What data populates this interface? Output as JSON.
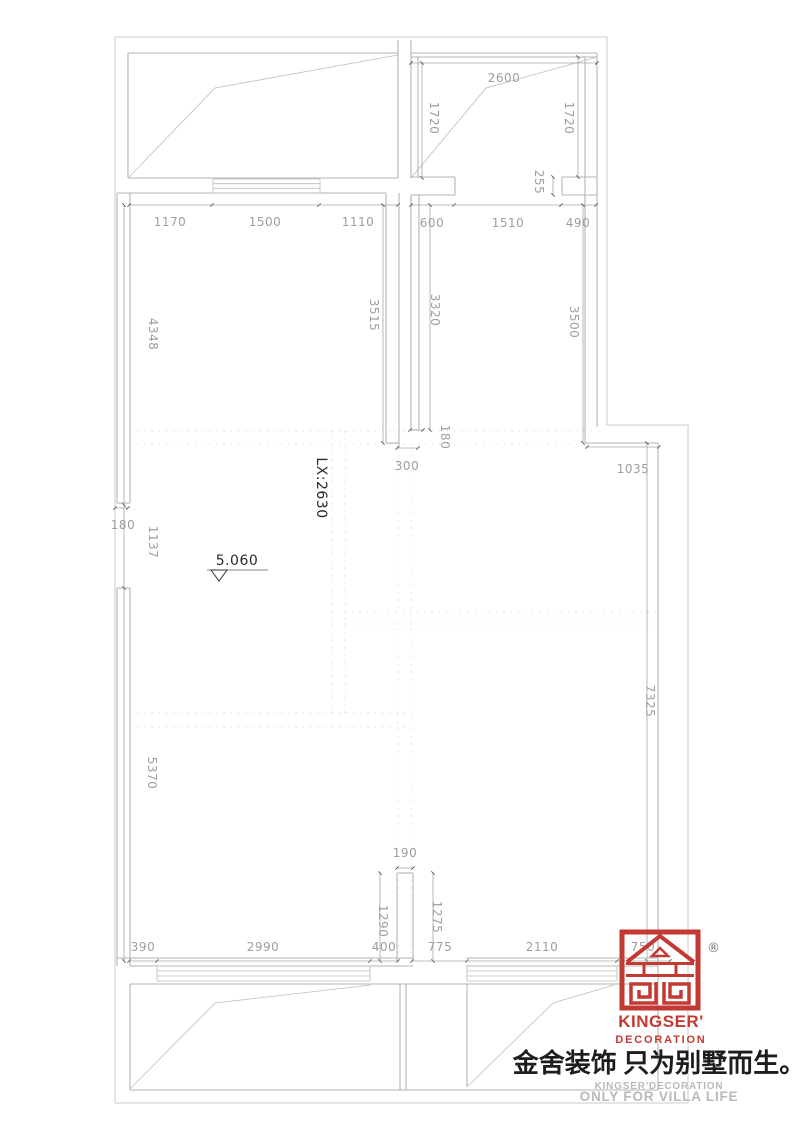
{
  "drawing": {
    "labels": {
      "beam": "LX:2630",
      "level": "5.060"
    },
    "dims": [
      {
        "id": "top-1170",
        "v": "1170"
      },
      {
        "id": "top-1500",
        "v": "1500"
      },
      {
        "id": "top-1110",
        "v": "1110"
      },
      {
        "id": "top-600",
        "v": "600"
      },
      {
        "id": "top-1510",
        "v": "1510"
      },
      {
        "id": "top-490",
        "v": "490"
      },
      {
        "id": "tr-2600",
        "v": "2600"
      },
      {
        "id": "tr-1720-left",
        "v": "1720"
      },
      {
        "id": "tr-1720-right",
        "v": "1720"
      },
      {
        "id": "tr-255",
        "v": "255"
      },
      {
        "id": "left-4348",
        "v": "4348"
      },
      {
        "id": "left-180",
        "v": "180"
      },
      {
        "id": "left-1137",
        "v": "1137"
      },
      {
        "id": "left-5370",
        "v": "5370"
      },
      {
        "id": "mid-3515",
        "v": "3515"
      },
      {
        "id": "mid-3320",
        "v": "3320"
      },
      {
        "id": "right-3500",
        "v": "3500"
      },
      {
        "id": "mid-180",
        "v": "180"
      },
      {
        "id": "mid-300",
        "v": "300"
      },
      {
        "id": "right-1035",
        "v": "1035"
      },
      {
        "id": "right-7325",
        "v": "7325"
      },
      {
        "id": "stub-190",
        "v": "190"
      },
      {
        "id": "stub-1290",
        "v": "1290"
      },
      {
        "id": "stub-1275",
        "v": "1275"
      },
      {
        "id": "bot-390",
        "v": "390"
      },
      {
        "id": "bot-2990",
        "v": "2990"
      },
      {
        "id": "bot-400",
        "v": "400"
      },
      {
        "id": "bot-775",
        "v": "775"
      },
      {
        "id": "bot-2110",
        "v": "2110"
      },
      {
        "id": "bot-750",
        "v": "750"
      }
    ]
  },
  "brand": {
    "registered": "®",
    "name": "KINGSER'",
    "subtitle": "DECORATION",
    "tagline_cn": "金舍装饰 只为别墅而生。",
    "tagline_en_small": "KINGSER'DECORATION",
    "tagline_en": "ONLY FOR VILLA LIFE",
    "red": "#c23a33"
  }
}
